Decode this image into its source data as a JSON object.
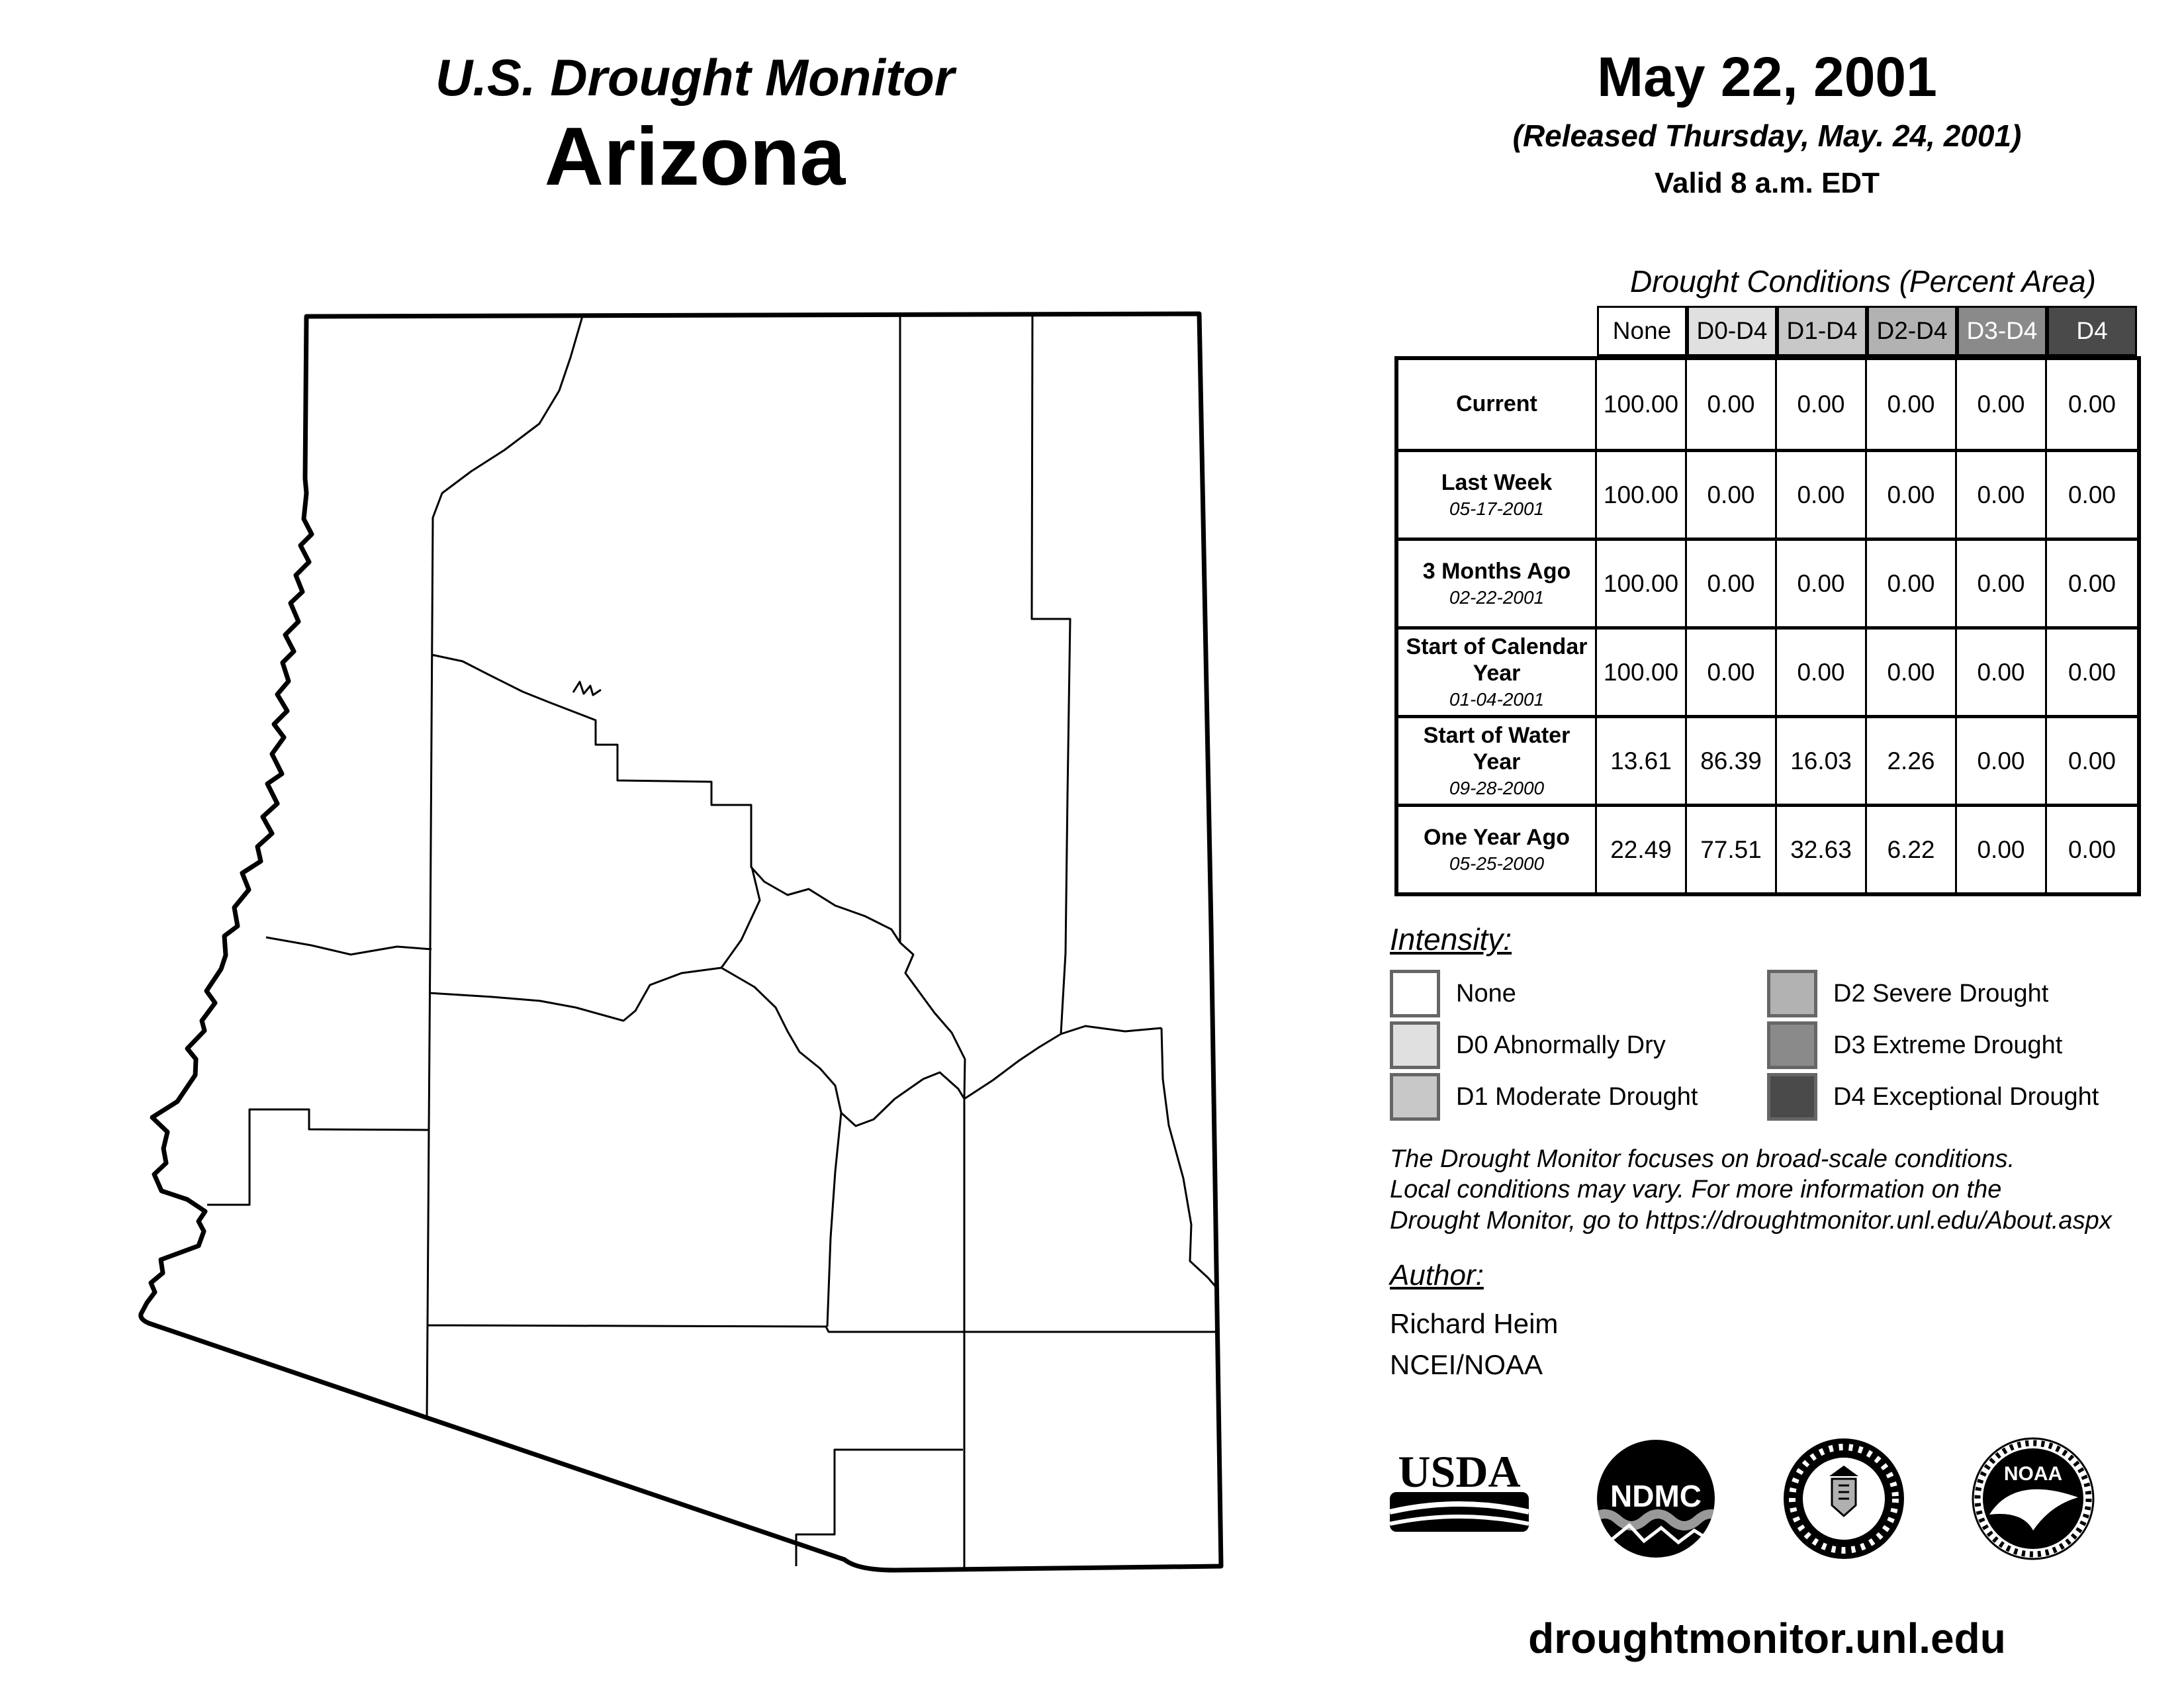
{
  "header": {
    "title": "U.S. Drought Monitor",
    "subtitle": "Arizona"
  },
  "date_block": {
    "date": "May 22, 2001",
    "released": "(Released Thursday, May. 24, 2001)",
    "valid": "Valid 8 a.m. EDT"
  },
  "table": {
    "title": "Drought Conditions (Percent Area)",
    "columns": [
      {
        "label": "None",
        "header_style": "background:#ffffff;color:#000000"
      },
      {
        "label": "D0-D4",
        "header_style": "background:#e0e0e0;color:#000000"
      },
      {
        "label": "D1-D4",
        "header_style": "background:#c8c8c8;color:#000000"
      },
      {
        "label": "D2-D4",
        "header_style": "background:#b2b2b2;color:#000000"
      },
      {
        "label": "D3-D4",
        "header_style": "background:#8a8a8a;color:#ffffff"
      },
      {
        "label": "D4",
        "header_style": "background:#4a4a4a;color:#ffffff"
      }
    ],
    "rows": [
      {
        "label": "Current",
        "date": "",
        "values": [
          "100.00",
          "0.00",
          "0.00",
          "0.00",
          "0.00",
          "0.00"
        ]
      },
      {
        "label": "Last Week",
        "date": "05-17-2001",
        "values": [
          "100.00",
          "0.00",
          "0.00",
          "0.00",
          "0.00",
          "0.00"
        ]
      },
      {
        "label": "3 Months Ago",
        "date": "02-22-2001",
        "values": [
          "100.00",
          "0.00",
          "0.00",
          "0.00",
          "0.00",
          "0.00"
        ]
      },
      {
        "label": "Start of Calendar Year",
        "date": "01-04-2001",
        "values": [
          "100.00",
          "0.00",
          "0.00",
          "0.00",
          "0.00",
          "0.00"
        ]
      },
      {
        "label": "Start of Water Year",
        "date": "09-28-2000",
        "values": [
          "13.61",
          "86.39",
          "16.03",
          "2.26",
          "0.00",
          "0.00"
        ]
      },
      {
        "label": "One Year Ago",
        "date": "05-25-2000",
        "values": [
          "22.49",
          "77.51",
          "32.63",
          "6.22",
          "0.00",
          "0.00"
        ]
      }
    ]
  },
  "legend": {
    "title": "Intensity:",
    "items": [
      {
        "label": "None",
        "swatch_style": "background:#ffffff"
      },
      {
        "label": "D0 Abnormally Dry",
        "swatch_style": "background:#e0e0e0"
      },
      {
        "label": "D1 Moderate Drought",
        "swatch_style": "background:#c8c8c8"
      },
      {
        "label": "D2 Severe Drought",
        "swatch_style": "background:#b2b2b2"
      },
      {
        "label": "D3 Extreme Drought",
        "swatch_style": "background:#8a8a8a"
      },
      {
        "label": "D4 Exceptional Drought",
        "swatch_style": "background:#4a4a4a"
      }
    ]
  },
  "disclaimer": {
    "lines": [
      "The Drought Monitor focuses on broad-scale conditions.",
      "Local conditions may vary. For more information on the",
      "Drought Monitor, go to https://droughtmonitor.unl.edu/About.aspx"
    ]
  },
  "author": {
    "title": "Author:",
    "name": "Richard Heim",
    "org": "NCEI/NOAA"
  },
  "logos": {
    "usda": "USDA",
    "ndmc": "NDMC",
    "noaa": "NOAA"
  },
  "footer": {
    "url": "droughtmonitor.unl.edu"
  }
}
